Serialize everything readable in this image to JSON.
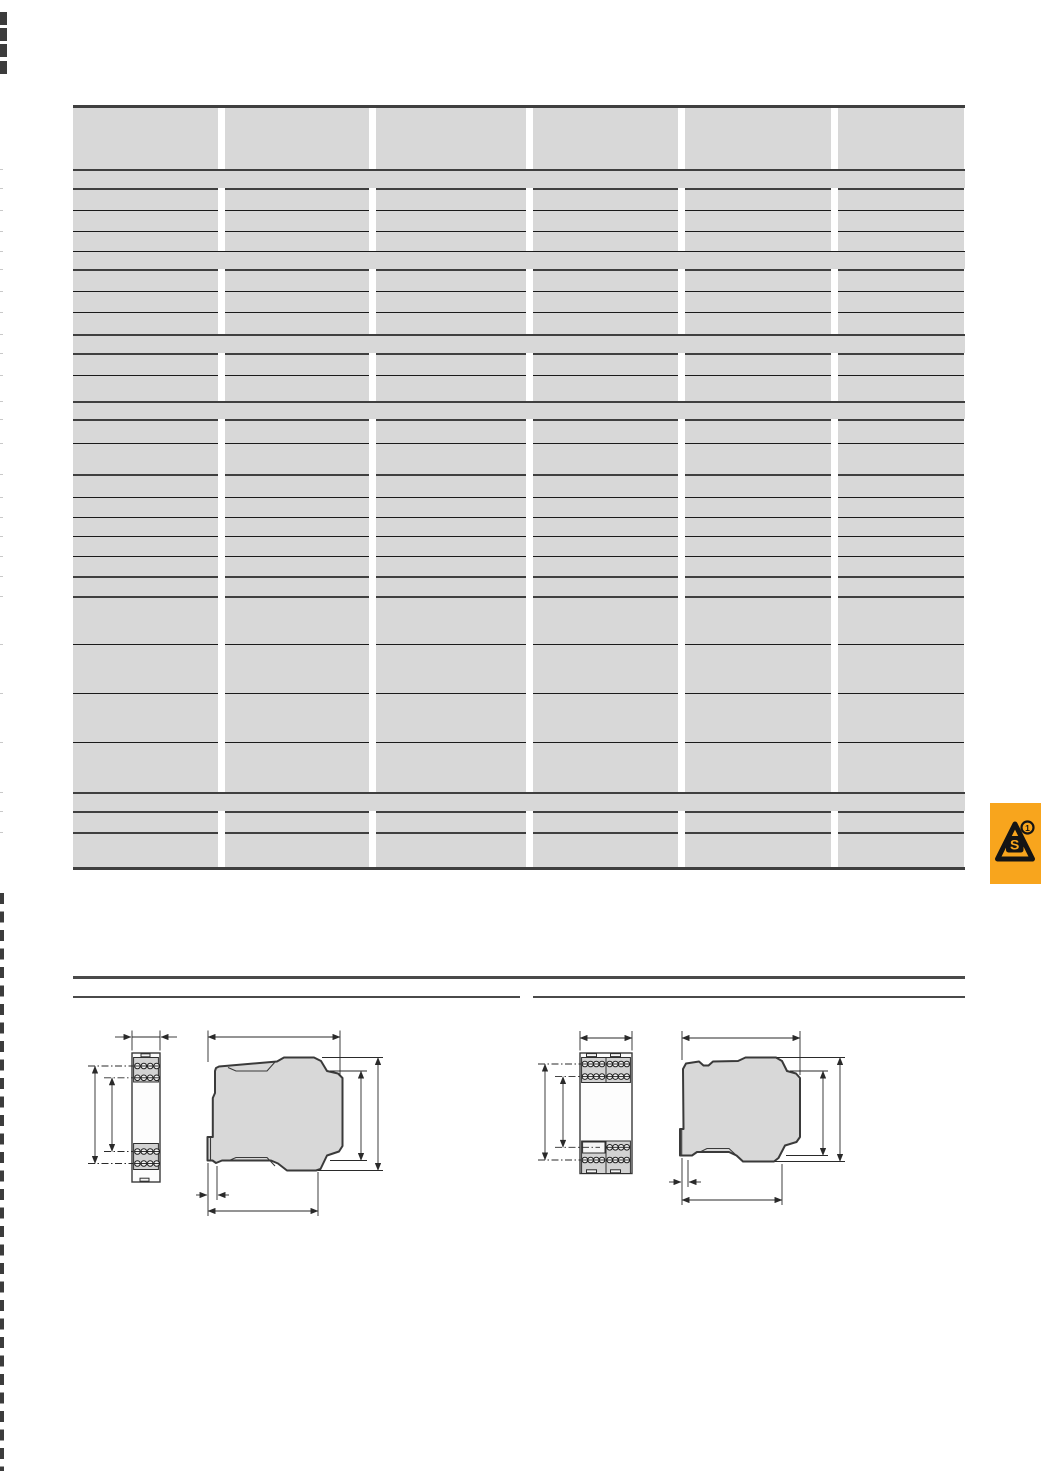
{
  "page": {
    "width": 1041,
    "height": 1471,
    "background": "#ffffff"
  },
  "colors": {
    "cell": "#d8d8d8",
    "border_dark": "#3f3f3f",
    "border_thin": "#1a1a1a",
    "rule": "#4a4a4a",
    "drawing_fill": "#d8d8d8",
    "drawing_stroke": "#3a3a3a",
    "dimension_line": "#2a2a2a",
    "badge_orange": "#f8a51d",
    "badge_black": "#141414",
    "edge_mark": "#3c3c3c",
    "row_tick": "#c9c9c9"
  },
  "table": {
    "x": 73,
    "y": 105,
    "width": 892,
    "columns": 6,
    "col_widths": [
      145,
      144,
      150,
      145,
      146,
      126
    ],
    "gap": 7,
    "rows": [
      {
        "type": "header",
        "h": 61,
        "border": "none"
      },
      {
        "type": "band",
        "h": 17,
        "border": "dark"
      },
      {
        "type": "cells",
        "h": 20,
        "border": "dark"
      },
      {
        "type": "cells",
        "h": 20,
        "border": "thin"
      },
      {
        "type": "cells",
        "h": 19,
        "border": "thin"
      },
      {
        "type": "band",
        "h": 17,
        "border": "thin"
      },
      {
        "type": "cells",
        "h": 20,
        "border": "dark"
      },
      {
        "type": "cells",
        "h": 20,
        "border": "thin"
      },
      {
        "type": "cells",
        "h": 21,
        "border": "thin"
      },
      {
        "type": "band",
        "h": 17,
        "border": "dark"
      },
      {
        "type": "cells",
        "h": 20,
        "border": "dark"
      },
      {
        "type": "cells",
        "h": 25,
        "border": "thin"
      },
      {
        "type": "band",
        "h": 16,
        "border": "dark"
      },
      {
        "type": "cells",
        "h": 22,
        "border": "dark"
      },
      {
        "type": "cells",
        "h": 30,
        "border": "thin"
      },
      {
        "type": "cells",
        "h": 21,
        "border": "dark"
      },
      {
        "type": "cells",
        "h": 19,
        "border": "thin"
      },
      {
        "type": "cells",
        "h": 18,
        "border": "thin"
      },
      {
        "type": "cells",
        "h": 19,
        "border": "thin"
      },
      {
        "type": "cells",
        "h": 19,
        "border": "thin"
      },
      {
        "type": "cells",
        "h": 18,
        "border": "dark"
      },
      {
        "type": "cells",
        "h": 46,
        "border": "dark"
      },
      {
        "type": "cells",
        "h": 48,
        "border": "thin"
      },
      {
        "type": "cells",
        "h": 48,
        "border": "thin"
      },
      {
        "type": "cells",
        "h": 49,
        "border": "thin"
      },
      {
        "type": "band",
        "h": 17,
        "border": "dark"
      },
      {
        "type": "cells",
        "h": 19,
        "border": "dark"
      },
      {
        "type": "cells",
        "h": 33,
        "border": "dark"
      }
    ]
  },
  "badge": {
    "icon": "safety-triangle-icon",
    "letter": "S",
    "superscript": "1",
    "x": 990,
    "y": 803,
    "w": 51,
    "h": 81
  },
  "rules": {
    "full": {
      "x": 73,
      "y": 976,
      "w": 892,
      "h": 3
    },
    "left": {
      "x": 73,
      "y": 996,
      "w": 447,
      "h": 2
    },
    "right": {
      "x": 533,
      "y": 996,
      "w": 432,
      "h": 2
    }
  },
  "edge_marks": {
    "blocks_y": [
      12,
      28,
      44,
      61
    ],
    "block_w": 7,
    "block_h": 13,
    "dash_from": 893,
    "dash_to": 1471
  },
  "drawings": {
    "left_module": {
      "views": [
        "front",
        "side"
      ],
      "terminal_rows": 4,
      "terminals_per_row": 4
    },
    "right_module": {
      "views": [
        "front",
        "side"
      ],
      "terminal_rows": 4,
      "terminal_groups_per_row": 2
    }
  }
}
